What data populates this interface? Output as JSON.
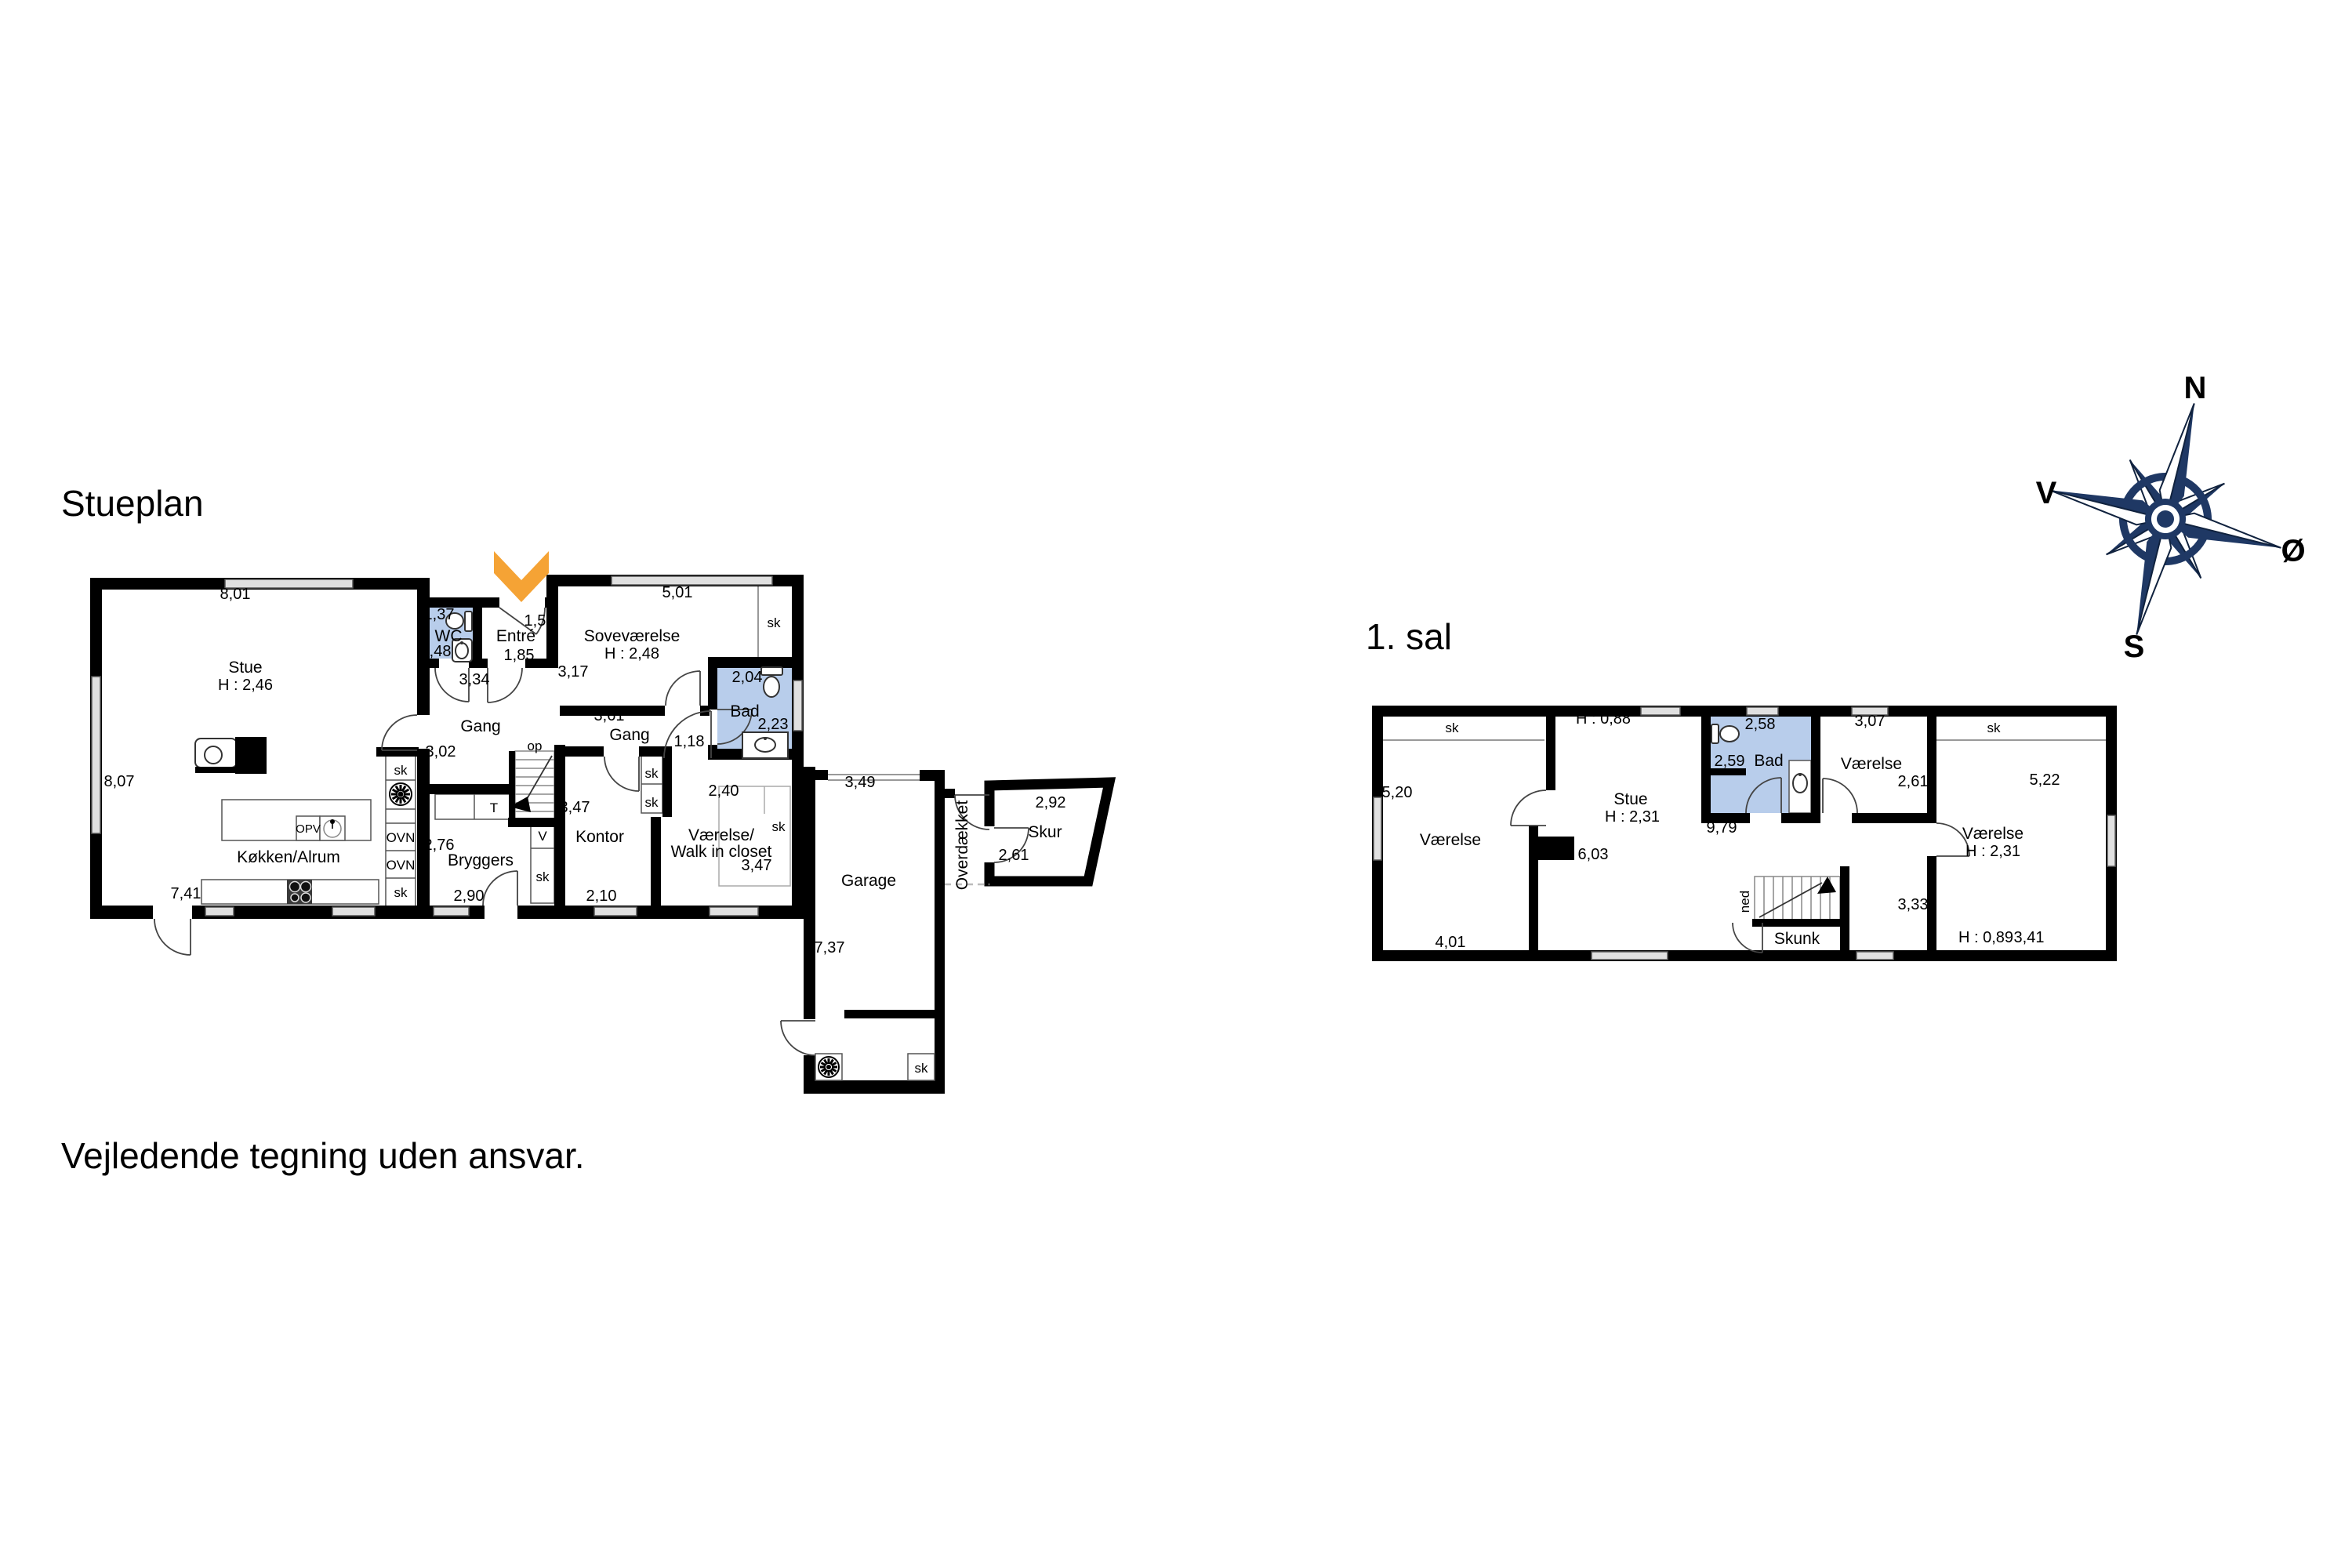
{
  "titles": {
    "ground_floor": "Stueplan",
    "first_floor": "1. sal"
  },
  "disclaimer": "Vejledende tegning uden ansvar.",
  "compass": {
    "north": "N",
    "south": "S",
    "east": "Ø",
    "west": "V"
  },
  "fixture_labels": {
    "sk": "sk",
    "ovn": "OVN",
    "opv": "OPV",
    "op": "op",
    "t": "T",
    "v": "V",
    "ned": "ned"
  },
  "colors": {
    "bathroom_fill": "#B8CDEB",
    "wall": "#000000",
    "window_fill": "#E0E0E0",
    "entrance_arrow": "#F5A335",
    "compass_navy": "#1F3864"
  },
  "ground_floor": {
    "stue": {
      "name": "Stue",
      "ceiling": "H : 2,46",
      "dim_top": "8,01",
      "dim_left": "8,07"
    },
    "koekken": {
      "name": "Køkken/Alrum",
      "dim_bottom": "7,41"
    },
    "wc": {
      "name": "WC",
      "dim_width": "1,37",
      "dim_depth": "1,48"
    },
    "entre": {
      "name": "Entré",
      "dim_width": "1,50",
      "dim_depth": "1,85"
    },
    "gang_vest": {
      "name": "Gang",
      "dim_width": "3,34",
      "dim_depth": "3,02"
    },
    "sovevaerelse": {
      "name": "Soveværelse",
      "ceiling": "H : 2,48",
      "dim_top": "5,01",
      "dim_left": "3,17"
    },
    "gang_midt": {
      "name": "Gang",
      "dim_width": "3,61",
      "dim_depth": "1,18"
    },
    "bad": {
      "name": "Bad",
      "dim_width": "2,04",
      "dim_depth": "2,23"
    },
    "bryggers": {
      "name": "Bryggers",
      "dim_depth": "2,76",
      "dim_bottom": "2,90"
    },
    "kontor": {
      "name": "Kontor",
      "dim_left": "3,47",
      "dim_bottom": "2,10"
    },
    "walk_in": {
      "name_line1": "Værelse/",
      "name_line2": "Walk in closet",
      "dim_top": "2,40",
      "dim_right": "3,47"
    },
    "garage": {
      "name": "Garage",
      "dim_top": "3,49",
      "dim_left": "7,37"
    },
    "overdaekket": {
      "name": "Overdækket"
    },
    "skur": {
      "name": "Skur",
      "dim_top": "2,92",
      "dim_left": "2,61"
    }
  },
  "first_floor": {
    "vaerelse_vest": {
      "name": "Værelse",
      "dim_left": "5,20",
      "dim_bottom": "4,01"
    },
    "stue": {
      "name": "Stue",
      "ceiling": "H : 2,31",
      "knee_height": "H : 0,88",
      "dim": "6,03"
    },
    "bad": {
      "name": "Bad",
      "dim_top": "2,58",
      "dim_inner": "2,59"
    },
    "vaerelse_midt": {
      "name": "Værelse",
      "dim_top": "3,07",
      "dim_right": "2,61"
    },
    "vaerelse_oest": {
      "name": "Værelse",
      "ceiling": "H : 2,31",
      "knee_height": "H : 0,89",
      "dim_left": "5,22",
      "dim_bottom": "3,41"
    },
    "gang": {
      "dim_total": "9,79",
      "dim_depth": "3,33"
    },
    "skunk": {
      "name": "Skunk"
    }
  }
}
